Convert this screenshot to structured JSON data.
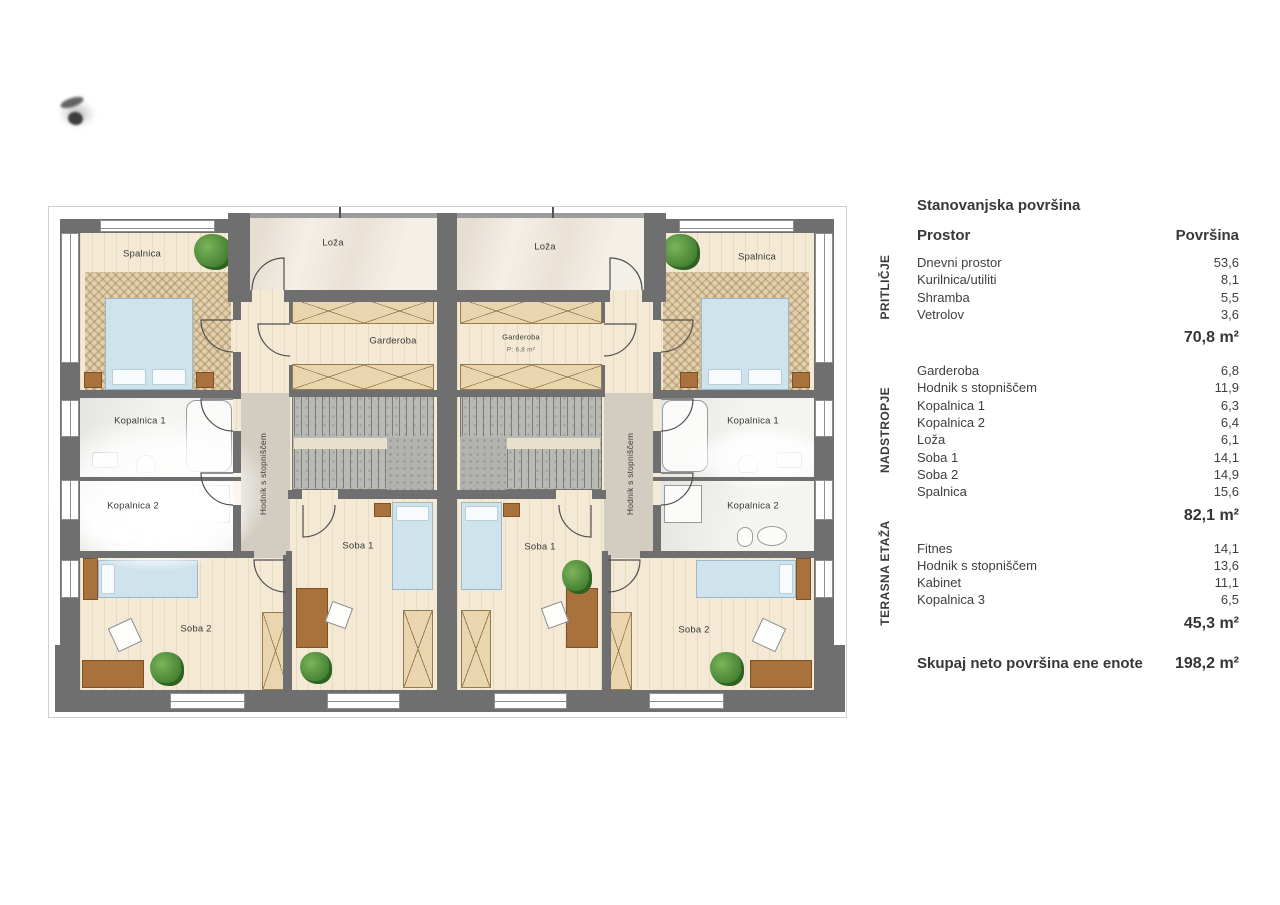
{
  "plan": {
    "rooms": {
      "spalnica_left": "Spalnica",
      "loza_left": "Loža",
      "garderoba_left": "Garderoba",
      "kopalnica1_left": "Kopalnica 1",
      "kopalnica2_left": "Kopalnica 2",
      "hodnik_left": "Hodnik s stopniščem",
      "soba1_left": "Soba 1",
      "soba2_left": "Soba 2",
      "loza_right": "Loža",
      "spalnica_right": "Spalnica",
      "garderoba_right": "Garderoba",
      "garderoba_right_area": "P: 6,8 m²",
      "kopalnica1_right": "Kopalnica 1",
      "kopalnica2_right": "Kopalnica 2",
      "hodnik_right": "Hodnik s stopniščem",
      "soba1_right": "Soba 1",
      "soba2_right": "Soba 2"
    }
  },
  "legend": {
    "title": "Stanovanjska površina",
    "columns": {
      "room": "Prostor",
      "area": "Površina"
    },
    "sections": [
      {
        "name": "PRITLIČJE",
        "rows": [
          {
            "label": "Dnevni prostor",
            "area": "53,6"
          },
          {
            "label": "Kurilnica/utiliti",
            "area": "8,1"
          },
          {
            "label": "Shramba",
            "area": "5,5"
          },
          {
            "label": "Vetrolov",
            "area": "3,6"
          }
        ],
        "subtotal": "70,8 m²"
      },
      {
        "name": "NADSTROPJE",
        "rows": [
          {
            "label": "Garderoba",
            "area": "6,8"
          },
          {
            "label": "Hodnik s stopniščem",
            "area": "11,9"
          },
          {
            "label": "Kopalnica 1",
            "area": "6,3"
          },
          {
            "label": "Kopalnica 2",
            "area": "6,4"
          },
          {
            "label": "Loža",
            "area": "6,1"
          },
          {
            "label": "Soba 1",
            "area": "14,1"
          },
          {
            "label": "Soba 2",
            "area": "14,9"
          },
          {
            "label": "Spalnica",
            "area": "15,6"
          }
        ],
        "subtotal": "82,1 m²"
      },
      {
        "name": "TERASNA ETAŽA",
        "rows": [
          {
            "label": "Fitnes",
            "area": "14,1"
          },
          {
            "label": "Hodnik s stopniščem",
            "area": "13,6"
          },
          {
            "label": "Kabinet",
            "area": "11,1"
          },
          {
            "label": "Kopalnica 3",
            "area": "6,5"
          }
        ],
        "subtotal": "45,3 m²"
      }
    ],
    "total": {
      "label": "Skupaj neto površina ene enote",
      "value": "198,2 m²"
    }
  },
  "colors": {
    "wall": "#6f6f6f",
    "floor_wood": "#f3e9d4",
    "floor_loza": "#f4efe7",
    "floor_bath": "#f4f4f1",
    "stairs": "#b9b9b5",
    "closet": "#ead6ae",
    "bed": "#cfe3ec",
    "furniture_wood": "#a9713c",
    "plant": "#4c9740"
  }
}
